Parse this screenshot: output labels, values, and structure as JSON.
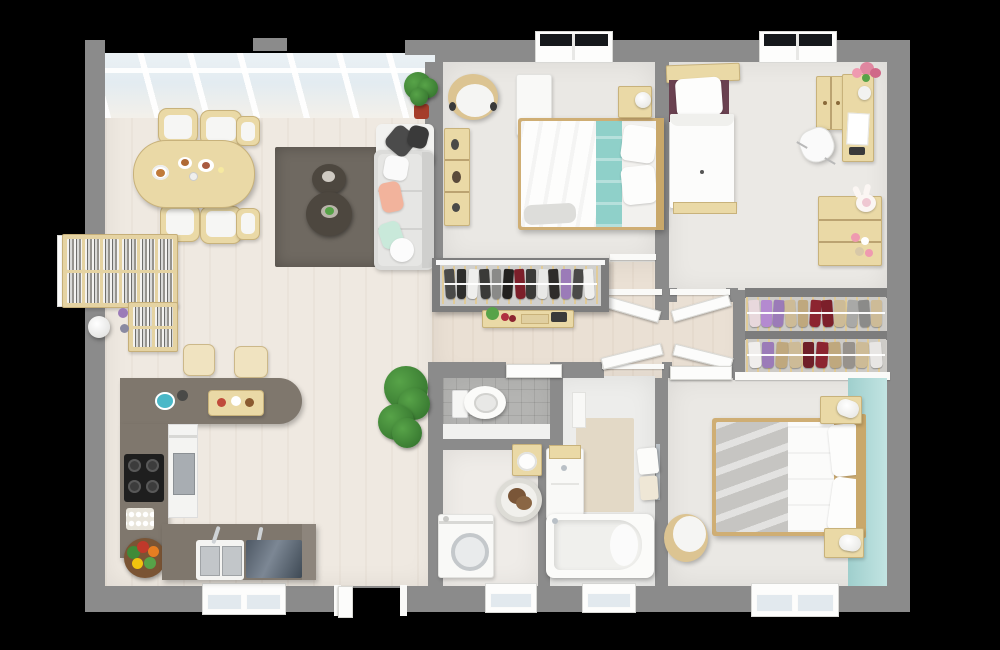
{
  "scene": {
    "type": "3d-floor-plan-top-view",
    "description": "Rendered top-down 3D floor plan of a three-bedroom apartment on a black background",
    "background": "#000000"
  },
  "palette": {
    "bg": "#000000",
    "wall": "#8b8b8b",
    "wallDark": "#7d7d7d",
    "floorLiving": "#efe9e1",
    "floorHall": "#eae0d4",
    "floorBedroom": "#eae8e4",
    "floorWc": "#b4b4b2",
    "floorLaundry": "#efece8",
    "floorBath": "#ededeb",
    "rug": "#6f6961",
    "rugTable": "#4d473f",
    "woodPale": "#ead9a6",
    "wood": "#dcc492",
    "woodDark": "#cfae74",
    "counter": "#7f776d",
    "counterFront": "#6f675f",
    "cabinetBlue": "#515b67",
    "sofa": "#dcdcda",
    "pillowDark": "#4b4b4b",
    "pillowPeach": "#f2b39c",
    "pillowMint": "#c9e9da",
    "tealBlanket": "#8fd0c9",
    "tealWall": "#a9d5d2",
    "maroon": "#6a4150",
    "glass": "#e3ecf1",
    "green": "#2f6d2a",
    "greenLight": "#57a348",
    "potRed": "#a53d2a",
    "steel": "#b9c0c6",
    "beige": "#e3d9c6",
    "dogBrown": "#7a5638",
    "grayBlanket": "#c6c5c2"
  },
  "rooms": [
    {
      "id": "living-dining-kitchen",
      "furniture": [
        "skylight-roof",
        "dining-table",
        "dining-chairs",
        "area-rug",
        "round-side-tables",
        "sofa",
        "throw-pillows",
        "bookshelf",
        "floor-lamp",
        "bar-counter",
        "bar-stools",
        "kitchen-counter",
        "cooktop",
        "oven-column",
        "kitchen-sink",
        "sink-cabinet",
        "vegetable-basket",
        "egg-tray",
        "cutting-board",
        "kettle",
        "potted-plant",
        "entry-door"
      ]
    },
    {
      "id": "bedroom-top-middle",
      "furniture": [
        "double-bed",
        "teal-runner",
        "pillows",
        "headboard",
        "nightstand",
        "table-lamp",
        "tub-chair",
        "wall-shelf",
        "white-dresser",
        "window",
        "wardrobe",
        "hallway-console"
      ]
    },
    {
      "id": "bedroom-top-right",
      "furniture": [
        "single-bed",
        "plum-pillows",
        "headboard-shelf",
        "desk",
        "desk-hutch",
        "desk-chair",
        "flower-vase",
        "toy-cabinet",
        "plush-bunny",
        "window"
      ]
    },
    {
      "id": "walk-in-closet",
      "furniture": [
        "clothes-rack-upper",
        "clothes-rack-lower"
      ]
    },
    {
      "id": "bedroom-bottom-right",
      "furniture": [
        "double-bed",
        "gray-blanket",
        "pillows",
        "nightstands",
        "table-lamps",
        "tub-chair",
        "teal-accent-wall",
        "window"
      ]
    },
    {
      "id": "wc",
      "furniture": [
        "toilet",
        "tiled-floor"
      ]
    },
    {
      "id": "laundry",
      "furniture": [
        "washing-machine",
        "pet-bed",
        "wall-sink",
        "window"
      ]
    },
    {
      "id": "bathroom",
      "furniture": [
        "bathtub",
        "vanity",
        "towel-rail",
        "tiled-panel",
        "window"
      ]
    },
    {
      "id": "hallway",
      "furniture": [
        "interior-doors",
        "console-table"
      ]
    }
  ],
  "racks": {
    "wardrobe": {
      "colors": [
        "#4a4a48",
        "#2e2e2c",
        "#efefed",
        "#3a3a38",
        "#8a8a88",
        "#23211f",
        "#7c1f2a",
        "#3a3a38",
        "#e8e8e6",
        "#2e2c2a",
        "#9b7bb8",
        "#4a4a48",
        "#f0f0ee"
      ]
    },
    "closetRow1": {
      "colors": [
        "#e8d8dc",
        "#b48ad0",
        "#9b7bb8",
        "#cdbb97",
        "#bfa87e",
        "#8c2430",
        "#7c1f2a",
        "#cdbb97",
        "#a9a9a7",
        "#8b8b89",
        "#cdbb97"
      ]
    },
    "closetRow2": {
      "colors": [
        "#f0eeec",
        "#9b7bb8",
        "#bfa87e",
        "#cdbb97",
        "#6f1f28",
        "#8c2430",
        "#bfa87e",
        "#97928c",
        "#cdbb97",
        "#e8e6e4"
      ]
    }
  }
}
